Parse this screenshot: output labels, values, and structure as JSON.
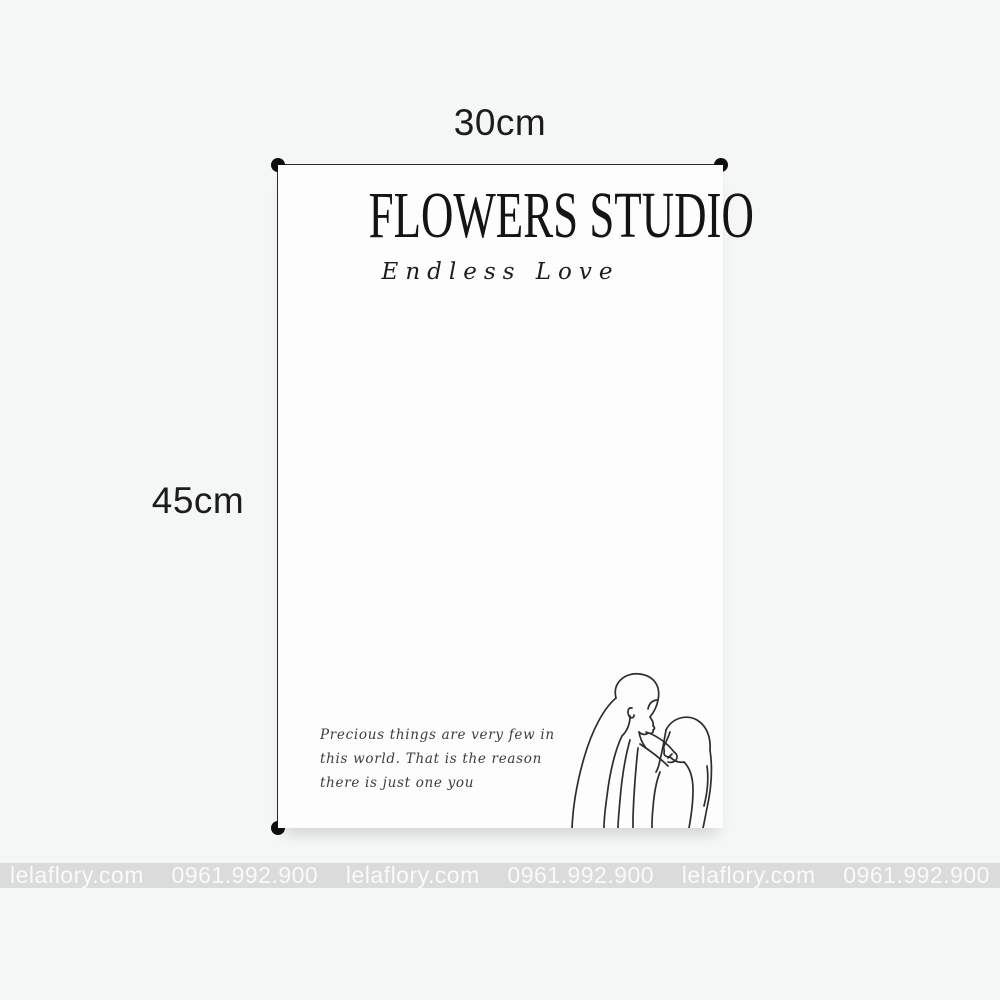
{
  "dimensions": {
    "width_label": "30cm",
    "height_label": "45cm"
  },
  "paper": {
    "brand_title": "FLOWERS STUDIO",
    "brand_subtitle": "Endless Love",
    "quote_lines": [
      "Precious things are very few in",
      "this world. That is the reason",
      "there is just one you"
    ],
    "illustration": "couple-line-art"
  },
  "watermark": {
    "items": [
      "lelaflory.com",
      "0961.992.900",
      "lelaflory.com",
      "0961.992.900",
      "lelaflory.com",
      "0961.992.900"
    ]
  },
  "colors": {
    "background": "#f5f6f6",
    "paper": "#fdfdfe",
    "ink": "#141414",
    "measurement_line": "#2b2b2b",
    "watermark_bar": "#dbdbdb",
    "watermark_text": "#fafafa"
  }
}
